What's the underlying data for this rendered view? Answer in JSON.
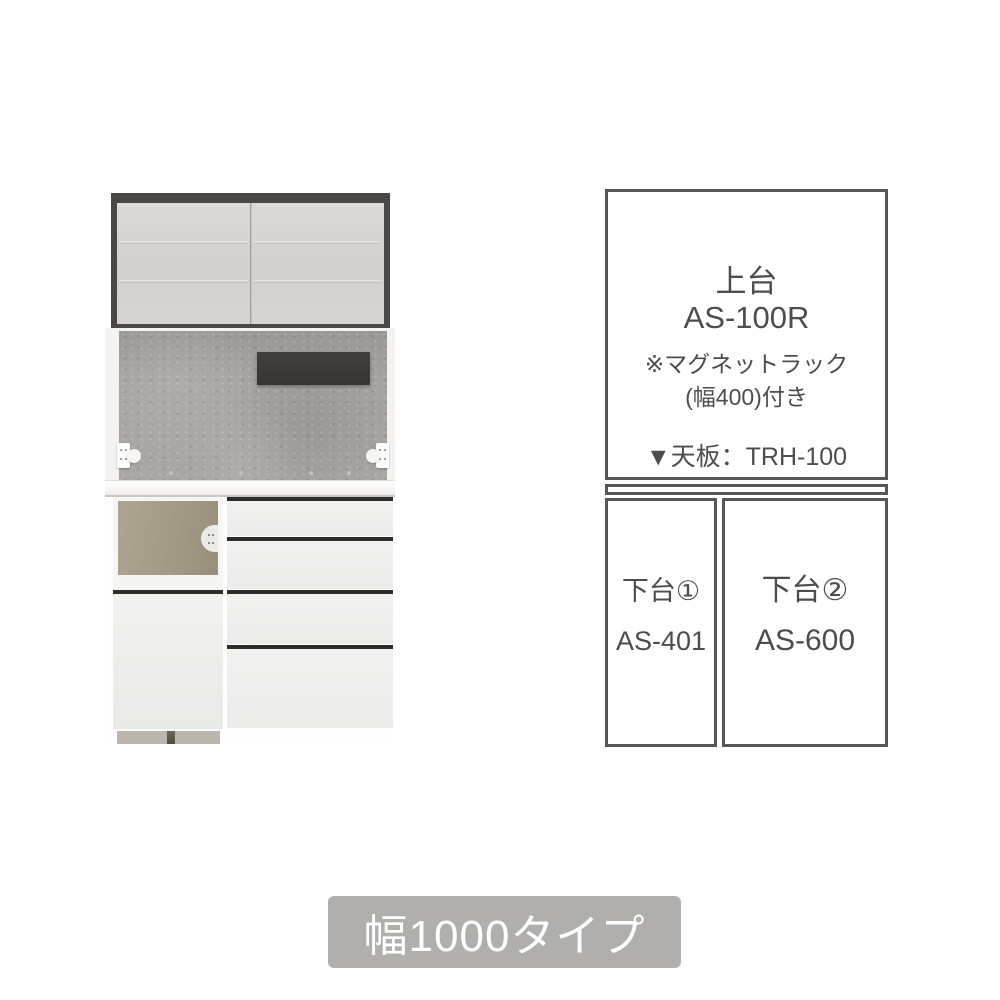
{
  "diagram": {
    "upper_unit": {
      "name": "上台",
      "model": "AS-100R",
      "note_line1": "※マグネットラック",
      "note_line2": "(幅400)付き",
      "top_board": "▼天板：TRH-100"
    },
    "lower_unit_left": {
      "name": "下台①",
      "model": "AS-401"
    },
    "lower_unit_right": {
      "name": "下台②",
      "model": "AS-600"
    }
  },
  "badge": {
    "label": "幅1000タイプ"
  },
  "colors": {
    "diagram_border": "#55555a",
    "diagram_text": "#4d4d50",
    "badge_background": "#b1afae",
    "badge_text": "#ffffff",
    "cabinet_frame": "#4b4745",
    "cabinet_door": "#d5d3d1",
    "back_panel": "#a4a19e",
    "magnet_rack": "#3c3937",
    "niche_interior": "#a29a86",
    "drawer_gap": "#2e2c2a",
    "kickplate": "#bbb7ae"
  }
}
